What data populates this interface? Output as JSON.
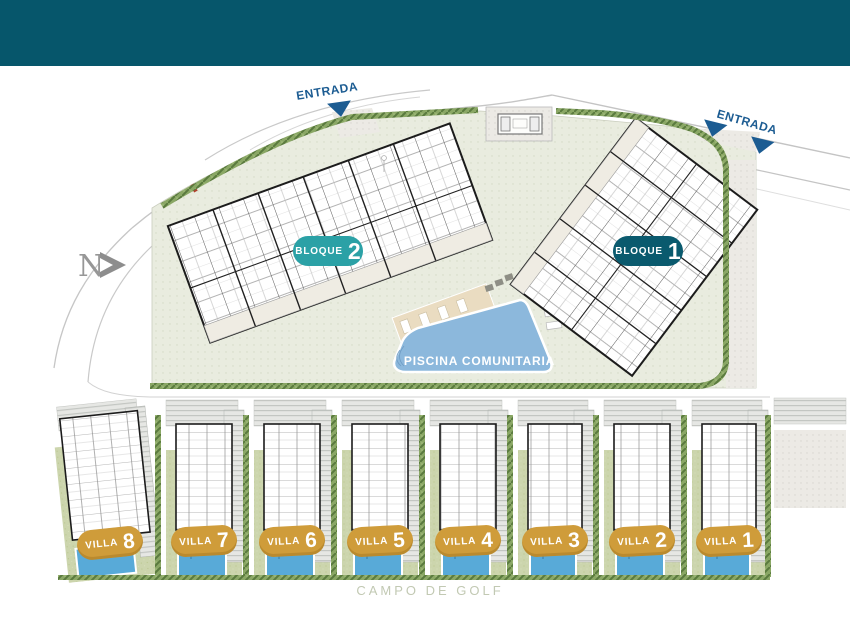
{
  "header": {
    "color": "#06566b"
  },
  "labels": {
    "entrance_top": "ENTRADA",
    "entrance_right": "ENTRADA",
    "north": "N",
    "pool": "PISCINA COMUNITARIA",
    "golf_course": "CAMPO DE GOLF"
  },
  "blocks": [
    {
      "name": "BLOQUE",
      "number": "2",
      "color": "#2ba1a6"
    },
    {
      "name": "BLOQUE",
      "number": "1",
      "color": "#0a5a6e"
    }
  ],
  "villas": [
    {
      "name": "VILLA",
      "number": "8"
    },
    {
      "name": "VILLA",
      "number": "7"
    },
    {
      "name": "VILLA",
      "number": "6"
    },
    {
      "name": "VILLA",
      "number": "5"
    },
    {
      "name": "VILLA",
      "number": "4"
    },
    {
      "name": "VILLA",
      "number": "3"
    },
    {
      "name": "VILLA",
      "number": "2"
    },
    {
      "name": "VILLA",
      "number": "1"
    }
  ],
  "colors": {
    "villa_badge": "#cf9c3a",
    "community_pool": "#8cb8dc",
    "villa_pool": "#58aad8",
    "entrance_text": "#1c5c92",
    "hedge_green": "#8aa765",
    "ground_sage": "#e9ecdf",
    "deck_tan": "#eadcc1",
    "garden_green": "#ccd5ad"
  }
}
